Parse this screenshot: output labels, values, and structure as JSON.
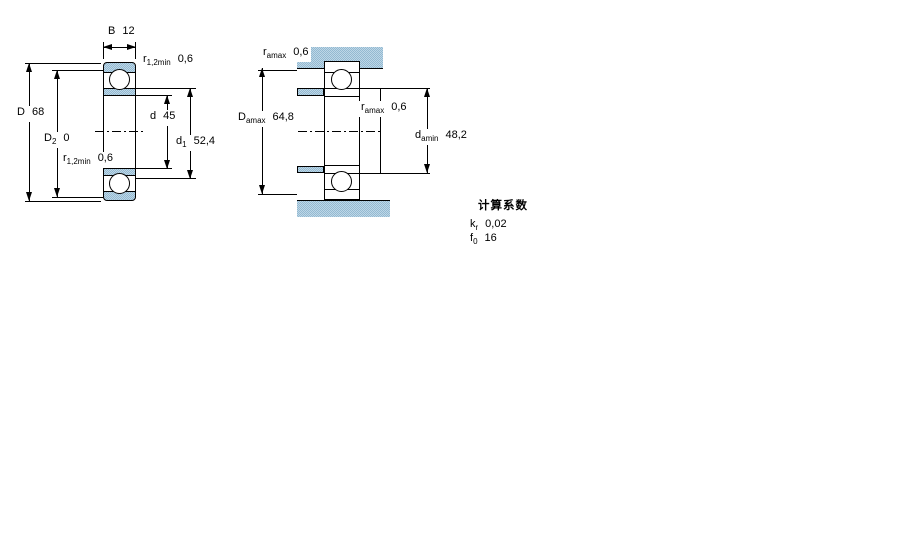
{
  "colors": {
    "section_blue_light": "#bdd7e7",
    "section_blue_dark": "#94b9d1",
    "line_black": "#000000",
    "background": "#ffffff"
  },
  "left_drawing": {
    "description": "bearing cross-section with boundary dimensions",
    "labels": {
      "width": {
        "main": "B",
        "sub": "",
        "value": "12"
      },
      "r_top": {
        "main": "r",
        "sub": "1,2min",
        "value": "0,6"
      },
      "outer_diameter": {
        "main": "D",
        "sub": "",
        "value": "68"
      },
      "d2": {
        "main": "D",
        "sub": "2",
        "value": "0"
      },
      "bore_diameter": {
        "main": "d",
        "sub": "",
        "value": "45"
      },
      "d1": {
        "main": "d",
        "sub": "1",
        "value": "52,4"
      },
      "r_bottom": {
        "main": "r",
        "sub": "1,2min",
        "value": "0,6"
      }
    }
  },
  "right_drawing": {
    "description": "bearing mounted with shaft and housing abutment dimensions",
    "labels": {
      "ra_top": {
        "main": "r",
        "sub": "amax",
        "value": "0,6"
      },
      "da_max": {
        "main": "D",
        "sub": "amax",
        "value": "64,8"
      },
      "ra_mid": {
        "main": "r",
        "sub": "amax",
        "value": "0,6"
      },
      "da_min": {
        "main": "d",
        "sub": "amin",
        "value": "48,2"
      }
    }
  },
  "calculation_factors": {
    "title": "计算系数",
    "rows": [
      {
        "main": "k",
        "sub": "r",
        "value": "0,02"
      },
      {
        "main": "f",
        "sub": "0",
        "value": "16"
      }
    ]
  }
}
